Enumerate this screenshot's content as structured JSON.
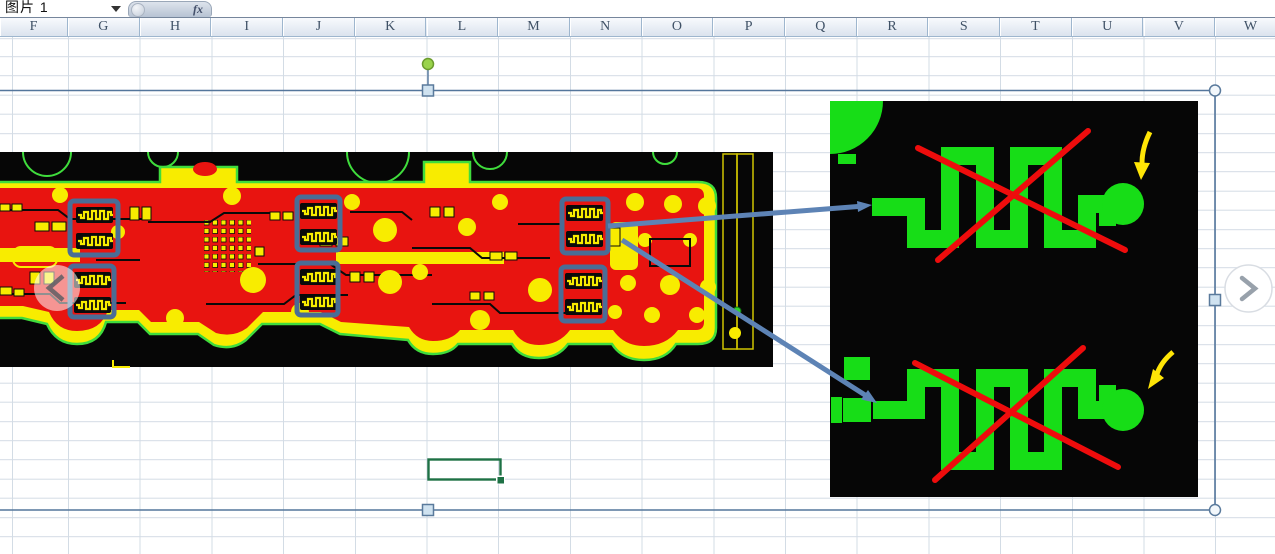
{
  "name_box": {
    "value": "图片 1",
    "dropdown_icon": "chevron-down"
  },
  "formula_bar": {
    "fx_label": "fx",
    "value": ""
  },
  "column_headers": [
    "F",
    "G",
    "H",
    "I",
    "J",
    "K",
    "L",
    "M",
    "N",
    "O",
    "P",
    "Q",
    "R",
    "S",
    "T",
    "U",
    "V",
    "W"
  ],
  "picture_selection": {
    "selected_object": "图片 1",
    "handle_kinds": [
      "rotate",
      "top-middle",
      "right-middle",
      "bottom-middle",
      "top-right-corner",
      "bottom-right-corner"
    ]
  },
  "nav": {
    "prev_icon": "chevron-left",
    "next_icon": "chevron-right"
  },
  "annotations": {
    "highlight_boxes": {
      "count": 6,
      "content": "serpentine-resistor-pairs"
    },
    "callout_arrows": {
      "count": 2
    },
    "crossed_out_traces": {
      "count": 2
    },
    "pointer_arrows": {
      "count": 2,
      "target": "round-pads"
    }
  },
  "colors": {
    "grid_line": "#d3dce5",
    "header_grad_top": "#f8fafd",
    "header_grad_bottom": "#dbe3ee",
    "header_border": "#9eb6ce",
    "header_top_line": "#76869c",
    "header_text": "#3f5166",
    "pcb_black": "#060606",
    "pcb_red": "#e81410",
    "pcb_yellow": "#f8ec00",
    "pcb_green": "#3fdc3c",
    "trace_green": "#17dd17",
    "cross_red": "#ee0c0c",
    "arrow_yellow": "#ffe506",
    "arrow_blue": "#5d83b5",
    "highlight_blue": "#4a6d96",
    "selection_border": "#54769c",
    "handle_fill": "#cfe2f0",
    "handle_border": "#5a7a9c",
    "rotation_green": "#9ad34c",
    "cell_green": "#1e7145",
    "chevron_gray": "#98a1ab"
  }
}
